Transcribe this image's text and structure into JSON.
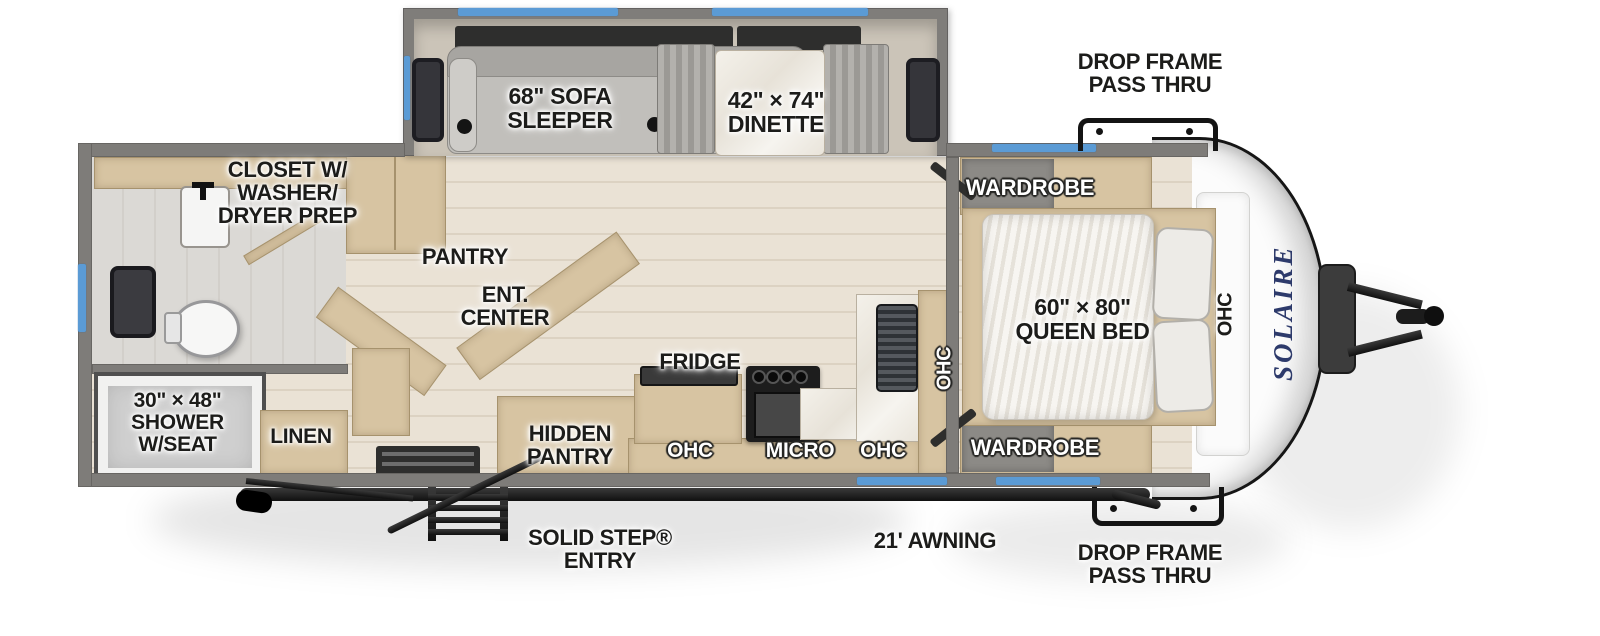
{
  "title": "Solaire travel trailer floor plan",
  "colors": {
    "accent_blue": "#5b9bd5",
    "wall_gray": "#7e7c79",
    "cabinet_tan": "#d7c4a2",
    "floor_wood": "#e8e0d3",
    "logo_navy": "#2d3a6b"
  },
  "slideout": {
    "sofa_label": "68\" SOFA\nSLEEPER",
    "dinette_label": "42\" × 74\"\nDINETTE"
  },
  "bathroom": {
    "closet_label": "CLOSET W/\nWASHER/\nDRYER PREP",
    "shower_label": "30\" × 48\"\nSHOWER\nW/SEAT",
    "linen_label": "LINEN"
  },
  "living": {
    "pantry_label": "PANTRY",
    "ent_center_label": "ENT.\nCENTER",
    "hidden_pantry_label": "HIDDEN\nPANTRY"
  },
  "kitchen": {
    "fridge_label": "FRIDGE",
    "ohc_left_label": "OHC",
    "micro_label": "MICRO",
    "ohc_right_label": "OHC",
    "ohc_counter_label": "OHC"
  },
  "bedroom": {
    "wardrobe_top_label": "WARDROBE",
    "wardrobe_bottom_label": "WARDROBE",
    "bed_label": "60\" × 80\"\nQUEEN BED",
    "ohc_front_label": "OHC"
  },
  "exterior": {
    "drop_frame_top_label": "DROP FRAME\nPASS THRU",
    "drop_frame_bottom_label": "DROP FRAME\nPASS THRU",
    "awning_label": "21' AWNING",
    "entry_label": "SOLID STEP®\nENTRY",
    "brand_logo": "SOLAIRE"
  }
}
